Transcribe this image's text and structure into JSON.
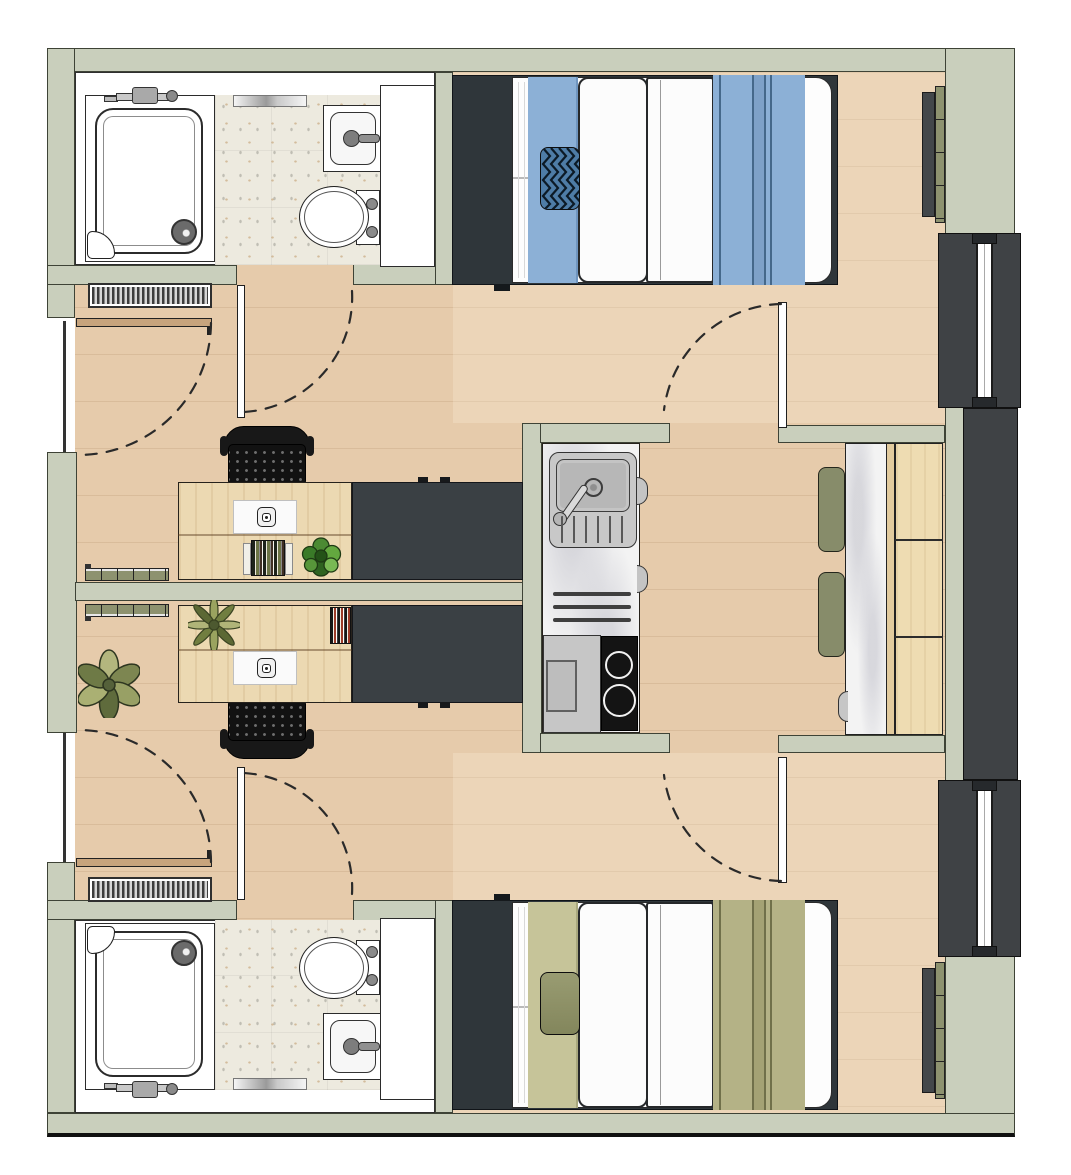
{
  "meta": {
    "type": "floor-plan",
    "title": "Twin studio apartment floor plan",
    "description": "Top-down architectural floor plan of two mirrored studio rooms (blue bedding above, olive bedding below) sharing a central kitchenette and dining nook, with full-height windows on the right and entry doors from a corridor on the left"
  },
  "palette": {
    "wall": "#c9cfbc",
    "floor": "#e6cbab",
    "tile": "#edeadf",
    "dark": "#3a4044",
    "headboard": "#2f363a",
    "winframe": "#3f4245",
    "blue": "#8cb0d6",
    "bluedark": "#45688a",
    "bluemid": "#7ea1c8",
    "navy": "#4e7ca6",
    "olive": "#b4b286",
    "olivedark": "#70704a",
    "olivemid": "#a4a274",
    "olivepale": "#c6c499",
    "cushion": "#878c6a",
    "radolive": "#8d926f",
    "wood": "#ecd9b2",
    "benchwood": "#eedcb2",
    "doorwood": "#c7a47d",
    "marble": "#f3f3f3",
    "steel": "#c8c8c8",
    "hob": "#141414"
  },
  "units": {
    "studio_top": {
      "rooms": [
        "entry-hall",
        "bathroom",
        "sleeping-area",
        "work-area"
      ],
      "furniture": [
        "shower",
        "washbasin",
        "toilet",
        "bathroom-cabinet",
        "entry-radiator",
        "entry-door",
        "double-bed",
        "blue-bedding",
        "zigzag-cushion",
        "desk",
        "laptop",
        "book-stack",
        "desk-plant",
        "task-chair",
        "wardrobe",
        "wall-radiator",
        "window-radiator"
      ]
    },
    "studio_bottom": {
      "rooms": [
        "entry-hall",
        "bathroom",
        "sleeping-area",
        "work-area"
      ],
      "furniture": [
        "shower",
        "washbasin",
        "toilet",
        "bathroom-cabinet",
        "entry-radiator",
        "entry-door",
        "double-bed",
        "olive-bedding",
        "accent-cushion",
        "desk",
        "laptop",
        "book-stack",
        "desk-plant",
        "floor-plant",
        "task-chair",
        "wardrobe",
        "wall-radiator",
        "window-radiator"
      ]
    },
    "shared_core": {
      "rooms": [
        "kitchen-niche",
        "inner-hall",
        "dining-nook"
      ],
      "furniture": [
        "kitchen-sink",
        "drainer-grooves",
        "faucet",
        "oven",
        "two-burner-hob",
        "cabinet-handles",
        "marble-table",
        "wood-bench",
        "seat-cushion-upper",
        "seat-cushion-lower"
      ],
      "doors": [
        "bedroom-door-top",
        "bedroom-door-bottom"
      ],
      "facade": [
        "full-height-window-upper",
        "spandrel-panel",
        "full-height-window-lower"
      ]
    }
  }
}
